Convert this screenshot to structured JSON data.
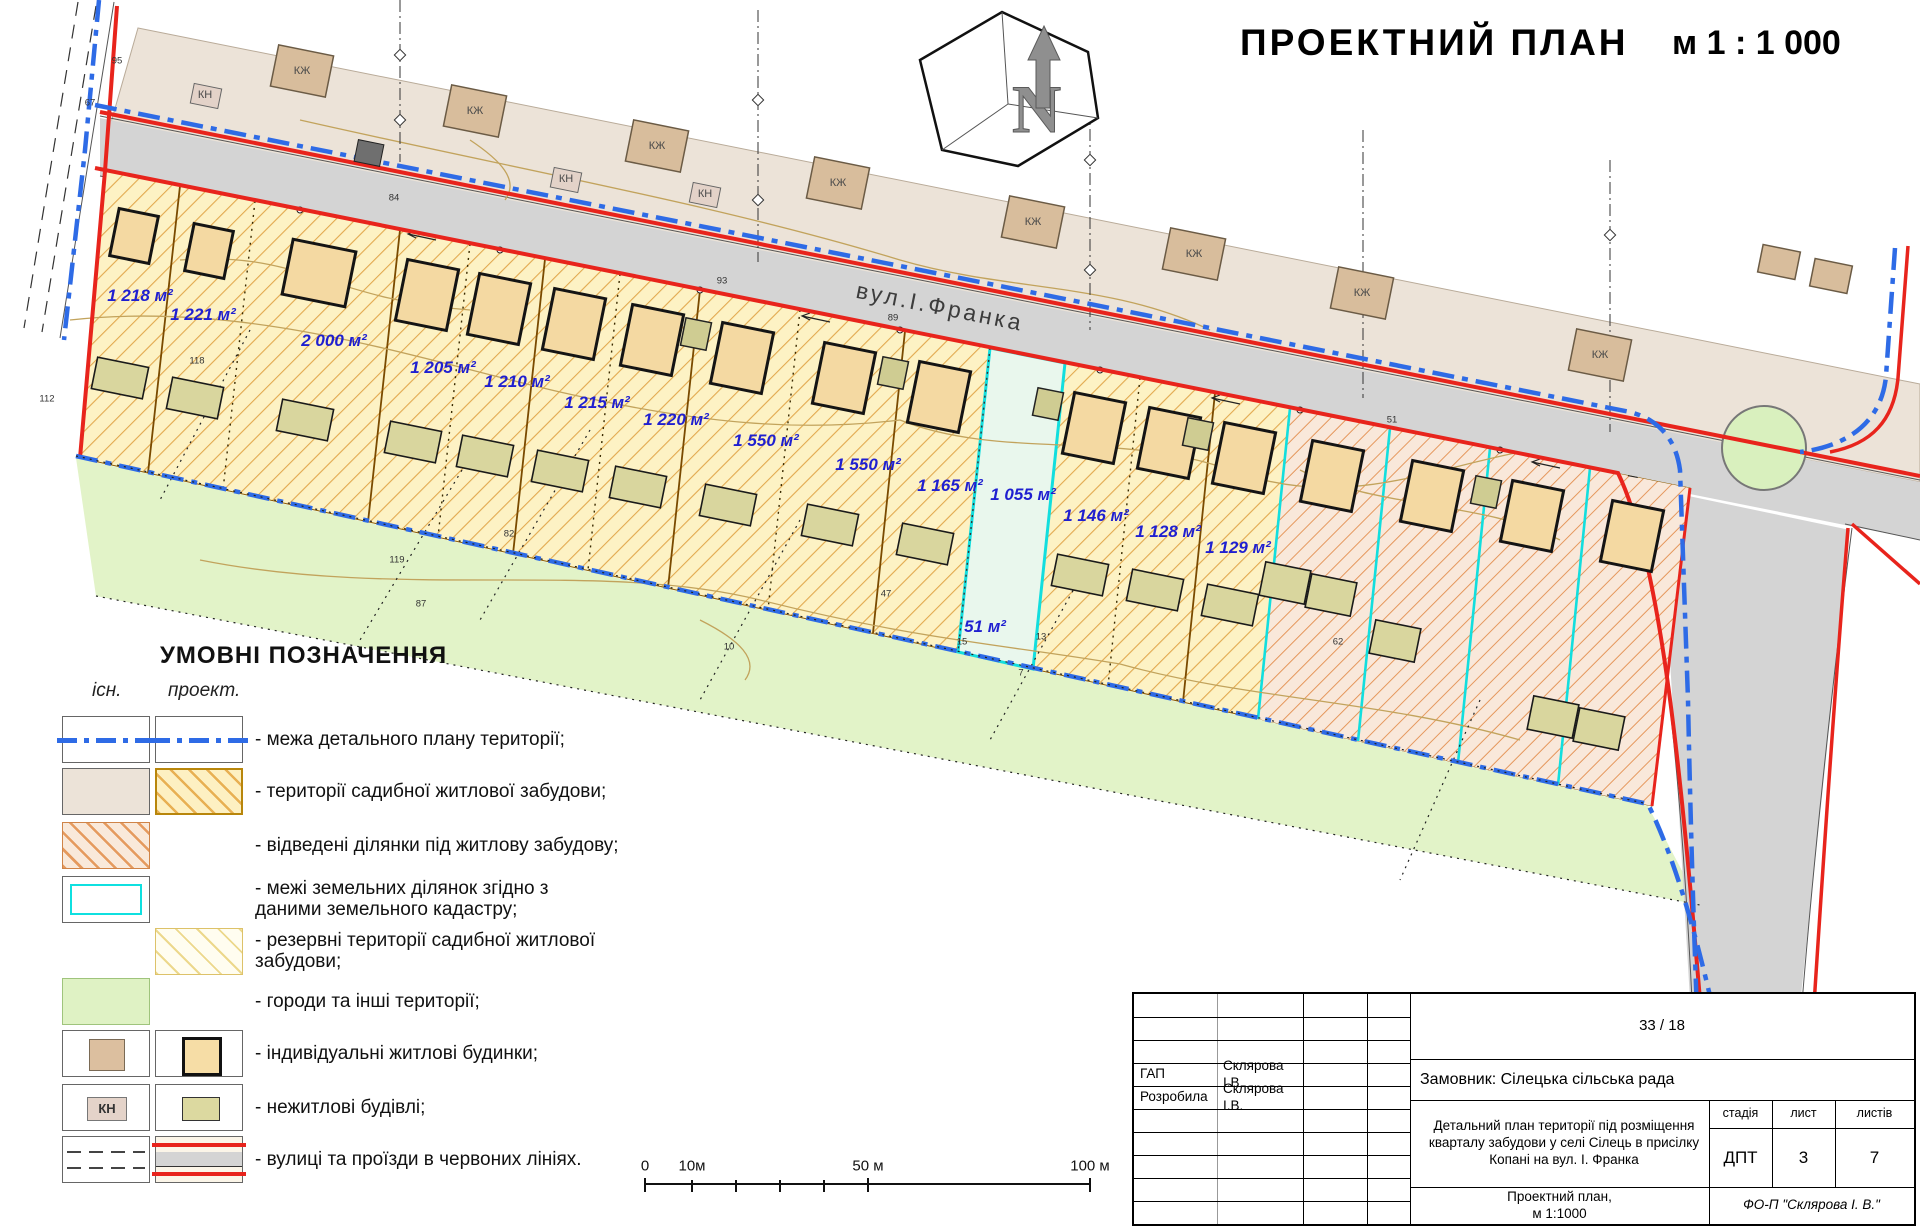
{
  "title": {
    "text": "ПРОЕКТНИЙ ПЛАН",
    "scale": "м 1 : 1 000"
  },
  "map": {
    "street": "вул.І.Франка",
    "north_mark": "N",
    "parcel_labels": [
      {
        "t": "1 218 м²",
        "x": 140,
        "y": 296
      },
      {
        "t": "1 221 м²",
        "x": 203,
        "y": 315
      },
      {
        "t": "2 000 м²",
        "x": 334,
        "y": 341
      },
      {
        "t": "1 205 м²",
        "x": 443,
        "y": 368
      },
      {
        "t": "1 210 м²",
        "x": 517,
        "y": 382
      },
      {
        "t": "1 215 м²",
        "x": 597,
        "y": 403
      },
      {
        "t": "1 220 м²",
        "x": 676,
        "y": 420
      },
      {
        "t": "1 550 м²",
        "x": 766,
        "y": 441
      },
      {
        "t": "1 550 м²",
        "x": 868,
        "y": 465
      },
      {
        "t": "1 165 м²",
        "x": 950,
        "y": 486
      },
      {
        "t": "1 055 м²",
        "x": 1023,
        "y": 495
      },
      {
        "t": "1 146 м²",
        "x": 1096,
        "y": 516
      },
      {
        "t": "1 128 м²",
        "x": 1168,
        "y": 532
      },
      {
        "t": "1 129 м²",
        "x": 1238,
        "y": 548
      },
      {
        "t": "51 м²",
        "x": 985,
        "y": 627
      }
    ],
    "point_numbers": [
      {
        "t": "95",
        "x": 117,
        "y": 61
      },
      {
        "t": "67",
        "x": 90,
        "y": 103
      },
      {
        "t": "84",
        "x": 394,
        "y": 198
      },
      {
        "t": "93",
        "x": 722,
        "y": 281
      },
      {
        "t": "89",
        "x": 893,
        "y": 318
      },
      {
        "t": "51",
        "x": 1392,
        "y": 420
      },
      {
        "t": "112",
        "x": 47,
        "y": 399
      },
      {
        "t": "118",
        "x": 197,
        "y": 361
      },
      {
        "t": "119",
        "x": 397,
        "y": 560
      },
      {
        "t": "87",
        "x": 421,
        "y": 604
      },
      {
        "t": "82",
        "x": 509,
        "y": 534
      },
      {
        "t": "47",
        "x": 886,
        "y": 594
      },
      {
        "t": "15",
        "x": 962,
        "y": 642
      },
      {
        "t": "13",
        "x": 1041,
        "y": 637
      },
      {
        "t": "10",
        "x": 729,
        "y": 647
      },
      {
        "t": "7",
        "x": 1021,
        "y": 673
      },
      {
        "t": "62",
        "x": 1338,
        "y": 642
      }
    ],
    "building_labels": [
      {
        "t": "КЖ",
        "x": 302,
        "y": 71
      },
      {
        "t": "КЖ",
        "x": 475,
        "y": 111
      },
      {
        "t": "КЖ",
        "x": 657,
        "y": 146
      },
      {
        "t": "КЖ",
        "x": 838,
        "y": 183
      },
      {
        "t": "КЖ",
        "x": 1033,
        "y": 222
      },
      {
        "t": "КЖ",
        "x": 1194,
        "y": 254
      },
      {
        "t": "КЖ",
        "x": 1362,
        "y": 293
      },
      {
        "t": "КЖ",
        "x": 1600,
        "y": 355
      },
      {
        "t": "КН",
        "x": 205,
        "y": 95
      },
      {
        "t": "КН",
        "x": 566,
        "y": 179
      },
      {
        "t": "КН",
        "x": 705,
        "y": 194
      }
    ]
  },
  "legend": {
    "title": "УМОВНІ ПОЗНАЧЕННЯ",
    "col_exist": "існ.",
    "col_proj": "проект.",
    "kn": "КН",
    "items": [
      {
        "label": "- межа детального плану території;"
      },
      {
        "label": "- території садибної житлової забудови;"
      },
      {
        "label": "- відведені ділянки під житлову забудову;"
      },
      {
        "label": "- межі земельних ділянок згідно з даними земельного кадастру;"
      },
      {
        "label": "- резервні території садибної житлової забудови;"
      },
      {
        "label": "- городи та інші території;"
      },
      {
        "label": "- індивідуальні житлові будинки;"
      },
      {
        "label": "- нежитлові будівлі;"
      },
      {
        "label": "- вулиці та проїзди в червоних лініях."
      }
    ]
  },
  "scalebar": {
    "ticks": [
      {
        "t": "0",
        "x": 645,
        "y": 1166
      },
      {
        "t": "10м",
        "x": 692,
        "y": 1166
      },
      {
        "t": "50 м",
        "x": 868,
        "y": 1166
      },
      {
        "t": "100 м",
        "x": 1090,
        "y": 1166
      }
    ]
  },
  "titleblock": {
    "doc_number": "33 / 18",
    "rows": [
      {
        "role": "ГАП",
        "name": "Склярова І.В."
      },
      {
        "role": "Розробила",
        "name": "Склярова І.В."
      }
    ],
    "client": "Замовник: Сілецька сільська рада",
    "project": "Детальний план території під розміщення кварталу забудови у селі Сілець в присілку Копані на вул. І. Франка",
    "stage_label": "стадія",
    "sheet_label": "лист",
    "sheets_label": "листів",
    "stage": "ДПТ",
    "sheet": "3",
    "sheets": "7",
    "drawing_name": "Проектний план,",
    "drawing_scale": "м 1:1000",
    "org": "ФО-П \"Склярова І. В.\""
  }
}
